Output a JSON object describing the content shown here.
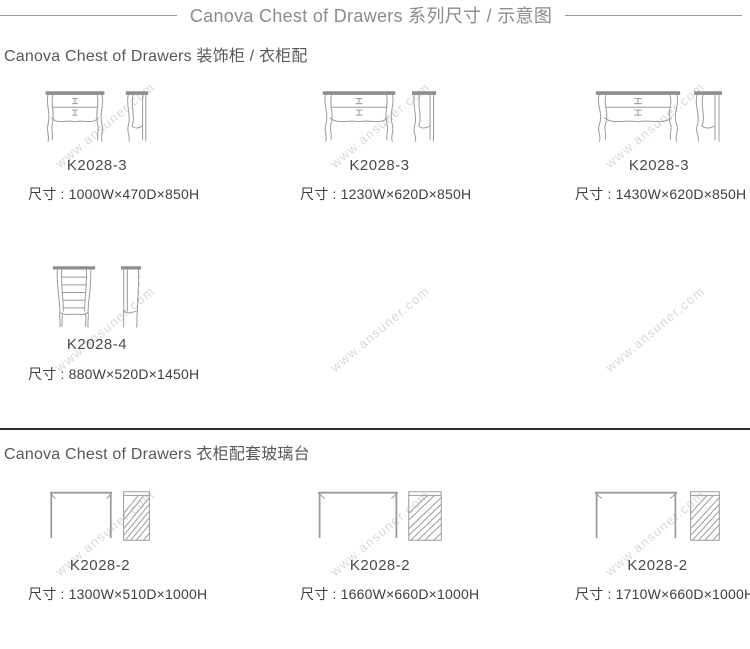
{
  "page": {
    "title": "Canova Chest of Drawers 系列尺寸 / 示意图",
    "watermark": "www.ansuner.com"
  },
  "colors": {
    "line_art": "#9b9b9b",
    "divider": "#2b2b2b",
    "title_text": "#8b8b8b",
    "body_text": "#3e3e3e"
  },
  "sections": [
    {
      "heading": "Canova Chest of Drawers 装饰柜 / 衣柜配",
      "items": [
        {
          "model": "K2028-3",
          "dims": "尺寸 : 1000W×470D×850H"
        },
        {
          "model": "K2028-3",
          "dims": "尺寸 : 1230W×620D×850H"
        },
        {
          "model": "K2028-3",
          "dims": "尺寸 : 1430W×620D×850H"
        },
        {
          "model": "K2028-4",
          "dims": "尺寸 : 880W×520D×1450H"
        }
      ]
    },
    {
      "heading": "Canova Chest of Drawers 衣柜配套玻璃台",
      "items": [
        {
          "model": "K2028-2",
          "dims": "尺寸 : 1300W×510D×1000H"
        },
        {
          "model": "K2028-2",
          "dims": "尺寸 : 1660W×660D×1000H"
        },
        {
          "model": "K2028-2",
          "dims": "尺寸 : 1710W×660D×1000H"
        }
      ]
    }
  ]
}
